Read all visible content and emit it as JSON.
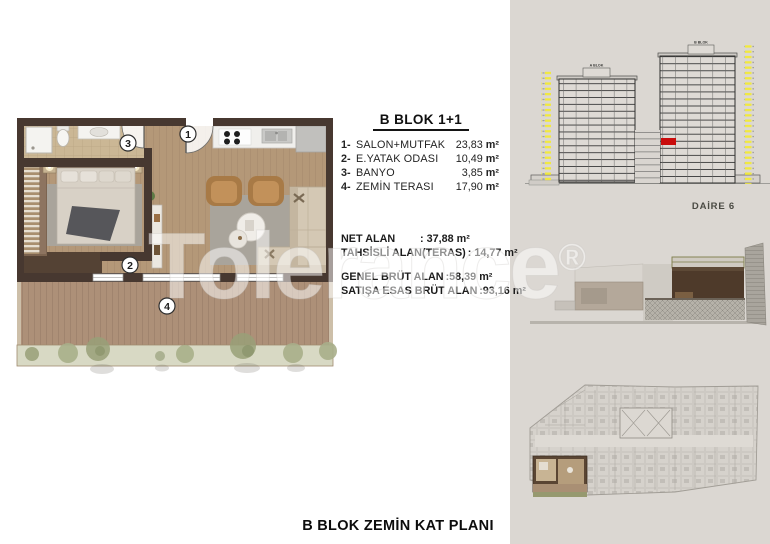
{
  "unit_info": {
    "title": "B BLOK 1+1",
    "rooms": [
      {
        "num": "1-",
        "name": "SALON+MUTFAK",
        "value": "23,83",
        "unit": "m²"
      },
      {
        "num": "2-",
        "name": "E.YATAK ODASI",
        "value": "10,49",
        "unit": "m²"
      },
      {
        "num": "3-",
        "name": "BANYO",
        "value": "3,85",
        "unit": "m²"
      },
      {
        "num": "4-",
        "name": "ZEMİN TERASI",
        "value": "17,90",
        "unit": "m²"
      }
    ],
    "metrics_net": [
      {
        "label": "NET ALAN",
        "value": ": 37,88 m²"
      },
      {
        "label": "TAHSİSLİ ALAN(TERAS)",
        "value": ": 14,77 m²"
      }
    ],
    "metrics_brut": [
      {
        "label": "GENEL BRÜT ALAN",
        "value": ":58,39 m²"
      },
      {
        "label": "SATIŞA ESAS BRÜT ALAN",
        "value": ":93,16 m²"
      }
    ]
  },
  "plan_markers": {
    "m1": "1",
    "m2": "2",
    "m3": "3",
    "m4": "4"
  },
  "elevation": {
    "tower_a": "A BLOK",
    "tower_b": "B BLOK",
    "caption": "DAİRE 6"
  },
  "watermark": {
    "text": "Tolerance",
    "reg": "®"
  },
  "footer": {
    "title": "B BLOK ZEMİN KAT PLANI"
  },
  "colors": {
    "highlight_red": "#c90c0c",
    "marker_yellow": "#f1e93e",
    "panel_bg": "#dbd7d2"
  }
}
